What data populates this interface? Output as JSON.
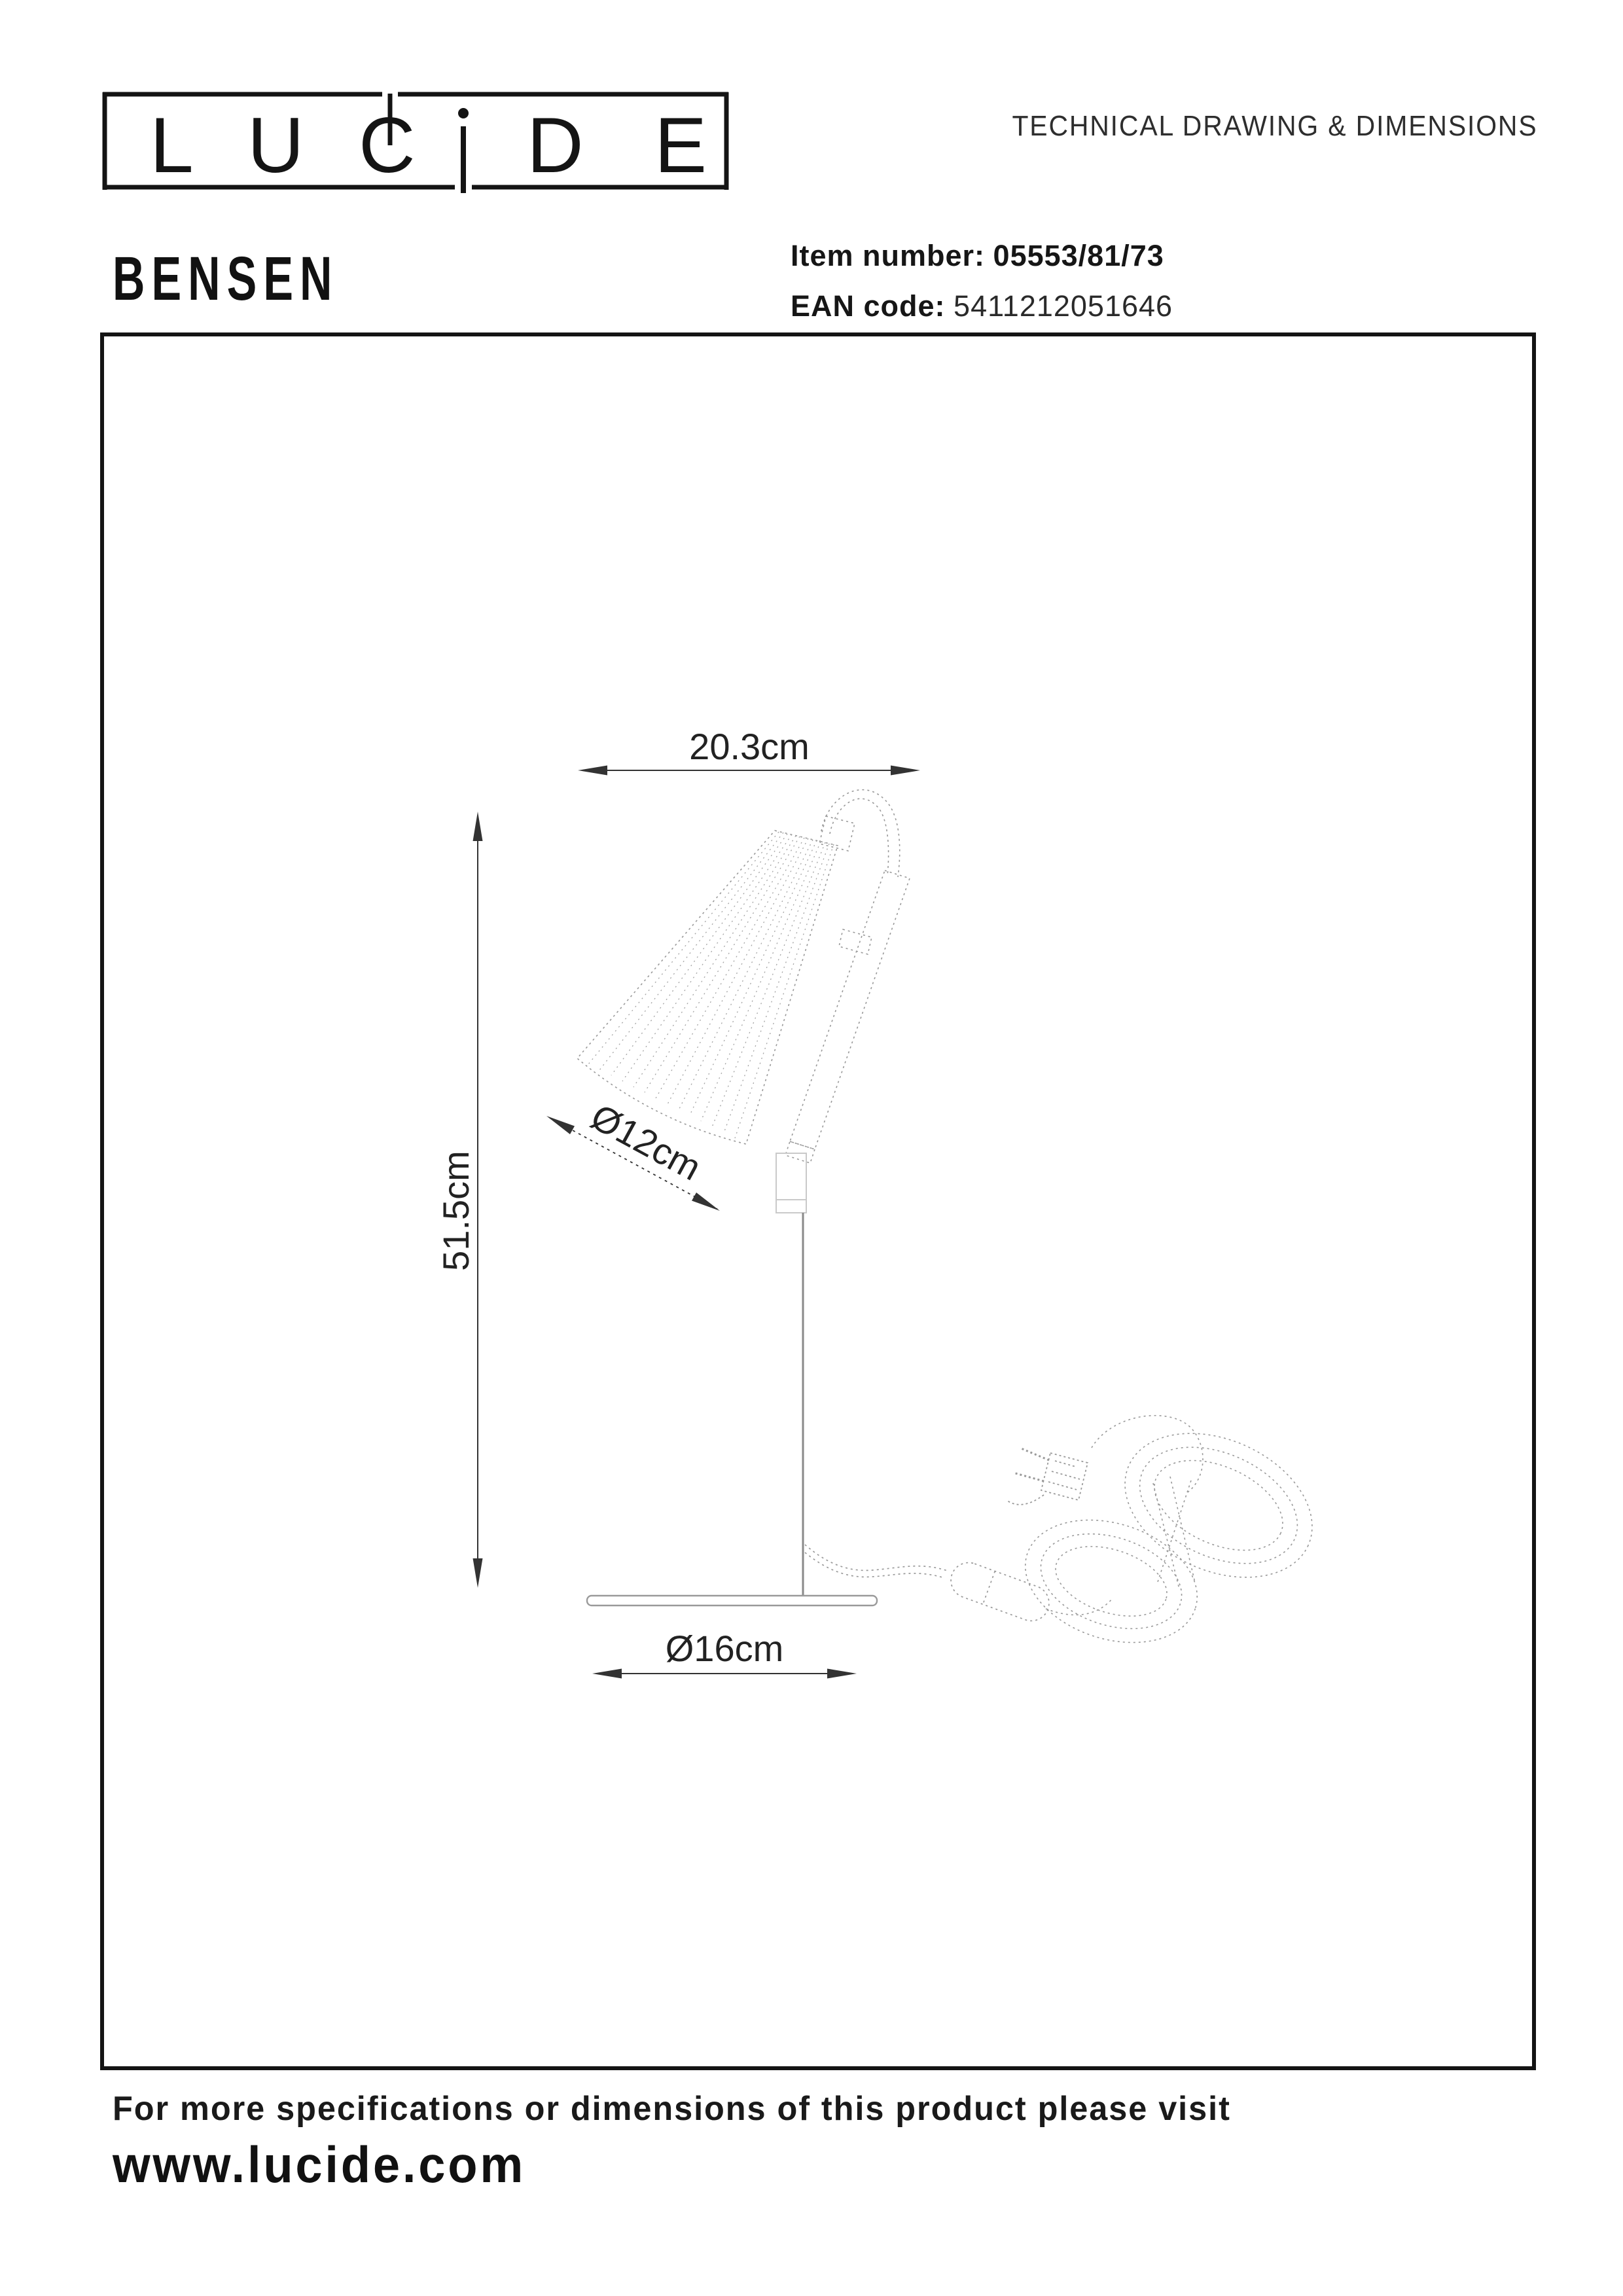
{
  "header": {
    "brand": [
      "L",
      "U",
      "C",
      "D",
      "E"
    ],
    "brand_name": "LUCIDE",
    "title": "TECHNICAL DRAWING & DIMENSIONS"
  },
  "product": {
    "name": "BENSEN",
    "item_label": "Item number:",
    "item_value": "05553/81/73",
    "ean_label": "EAN code:",
    "ean_value": "5411212051646"
  },
  "drawing": {
    "width_label": "20.3cm",
    "height_label": "51.5cm",
    "shade_diameter_label": "Ø12cm",
    "base_diameter_label": "Ø16cm"
  },
  "footer": {
    "note": "For more specifications or dimensions of this product please visit",
    "website": "www.lucide.com"
  },
  "colors": {
    "ink": "#141414",
    "dim_line": "#333333",
    "sketch_line": "#999999"
  }
}
